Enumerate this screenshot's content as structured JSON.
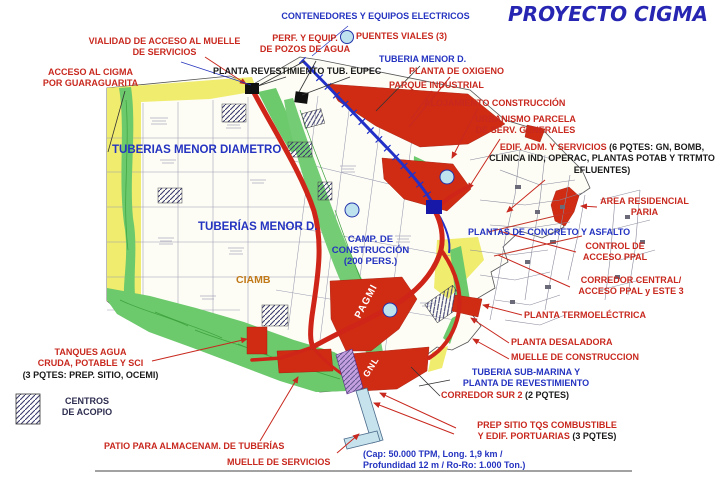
{
  "title": "PROYECTO CIGMA",
  "colors": {
    "red_label": "#c8281e",
    "blue_label": "#2433c0",
    "black_label": "#1a1a1a",
    "title_blue": "#2626b2",
    "map_red": "#d02c14",
    "map_green": "#6cc96c",
    "map_yellow": "#f0ec6e",
    "route_blue": "#2230c8",
    "pier_blue": "#c6e2ec"
  },
  "labels": {
    "contenedores": "CONTENEDORES Y EQUIPOS ELECTRICOS",
    "puentes_viales": "PUENTES VIALES (3)",
    "perf_pozos": "PERF. Y EQUIP.\nDE POZOS DE AGUA",
    "tuberia_menor_top": "TUBERIA MENOR D.",
    "planta_revestimiento": "PLANTA REVESTIMIENTO TUB. EUPEC",
    "planta_oxigeno": "PLANTA DE OXIGENO",
    "parque_industrial": "PARQUE INDUSTRIAL",
    "vialidad": "VIALIDAD DE ACCESO AL MUELLE\nDE SERVICIOS",
    "acceso_cigma": "ACCESO AL CIGMA\nPOR GUARAGUARITA",
    "alojamiento": "ALOJAMIENTO CONSTRUCCIÓN",
    "urbanismo": "URBANISMO PARCELA\nDE SERV. GENERALES",
    "edif_adm_red": "EDIF. ADM. Y SERVICIOS ",
    "edif_adm_black": "(6 PQTES: GN, BOMB, CLINICA IND, OPERAC, PLANTAS POTAB Y TRTMTO EFLUENTES)",
    "area_residencial": "AREA RESIDENCIAL\nPARIA",
    "plantas_concreto": "PLANTAS DE CONCRETO Y ASFALTO",
    "control_acceso": "CONTROL DE\nACCESO PPAL",
    "corredor_central": "CORREDOR CENTRAL/\nACCESO PPAL y ESTE 3",
    "planta_termoelectrica": "PLANTA TERMOELÉCTRICA",
    "planta_desaladora": "PLANTA DESALADORA",
    "muelle_construccion": "MUELLE DE CONSTRUCCION",
    "tuberia_submarina": "TUBERIA SUB-MARINA Y\nPLANTA DE REVESTIMIENTO",
    "corredor_sur_red": "CORREDOR SUR 2 ",
    "corredor_sur_black": "(2 PQTES)",
    "prep_sitio_red": "PREP SITIO TQS COMBUSTIBLE\nY EDIF. PORTUARIAS ",
    "prep_sitio_black": "(3 PQTES)",
    "cap_note": "(Cap: 50.000 TPM, Long. 1,9 km /\nProfundidad 12 m / Ro-Ro: 1.000 Ton.)",
    "tanques_red": "TANQUES AGUA\nCRUDA, POTABLE Y SCI\n",
    "tanques_black": "(3 PQTES: PREP. SITIO, OCEMI)",
    "centros_acopio": "CENTROS\nDE ACOPIO",
    "patio": "PATIO PARA ALMACENAM. DE TUBERÍAS",
    "muelle_servicios": "MUELLE DE  SERVICIOS"
  },
  "map_texts": {
    "tuberias_menor_diametro": "TUBERIAS MENOR DIAMETRO",
    "tuberias_menor_d": "TUBERÍAS MENOR D.",
    "camp_construccion": "CAMP. DE\nCONSTRUCCIÓN\n(200 PERS.)",
    "ciamb": "CIAMB",
    "pagmi": "PAGMI",
    "gnl": "GNL"
  }
}
